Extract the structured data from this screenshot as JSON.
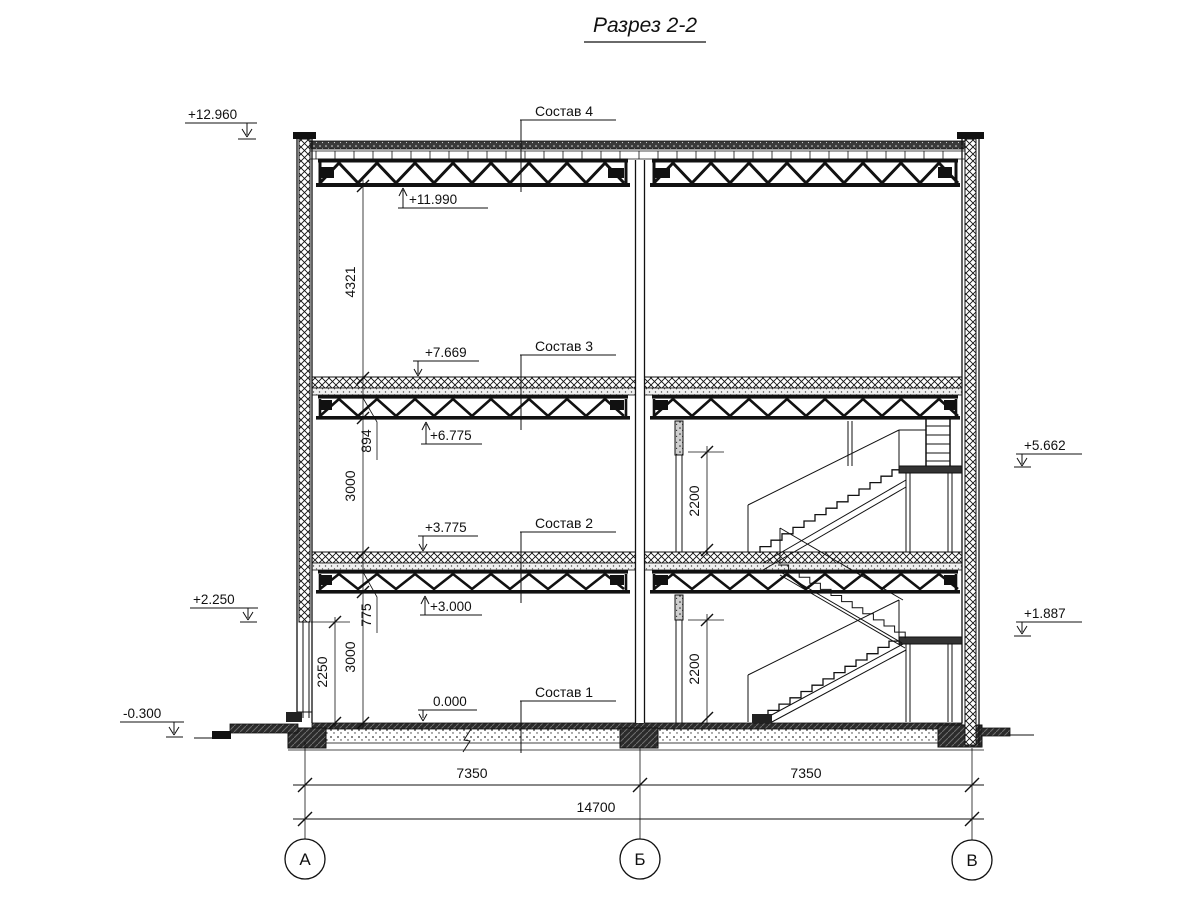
{
  "title": "Разрез 2-2",
  "floor_labels": {
    "s1": "Состав 1",
    "s2": "Состав 2",
    "s3": "Состав 3",
    "s4": "Состав 4"
  },
  "elevations": {
    "parapet_top": "+12.960",
    "roof_truss_bottom": "+11.990",
    "floor3_top": "+7.669",
    "truss3_bottom": "+6.775",
    "floor2_top": "+3.775",
    "truss2_bottom": "+3.000",
    "window_head": "+2.250",
    "ground_floor": "0.000",
    "site_level": "-0.300",
    "upper_landing": "+5.662",
    "lower_landing": "+1.887"
  },
  "dimensions": {
    "attic_height": "4321",
    "roof_slab_depth": "894",
    "story_upper": "3000",
    "floor_depth": "775",
    "story_lower": "3000",
    "window_height": "2250",
    "door_upper": "2200",
    "door_lower": "2200",
    "span_left": "7350",
    "span_right": "7350",
    "span_total": "14700"
  },
  "axes": {
    "left": "А",
    "center": "Б",
    "right": "В"
  },
  "colors": {
    "line": "#111111",
    "background": "#ffffff"
  }
}
